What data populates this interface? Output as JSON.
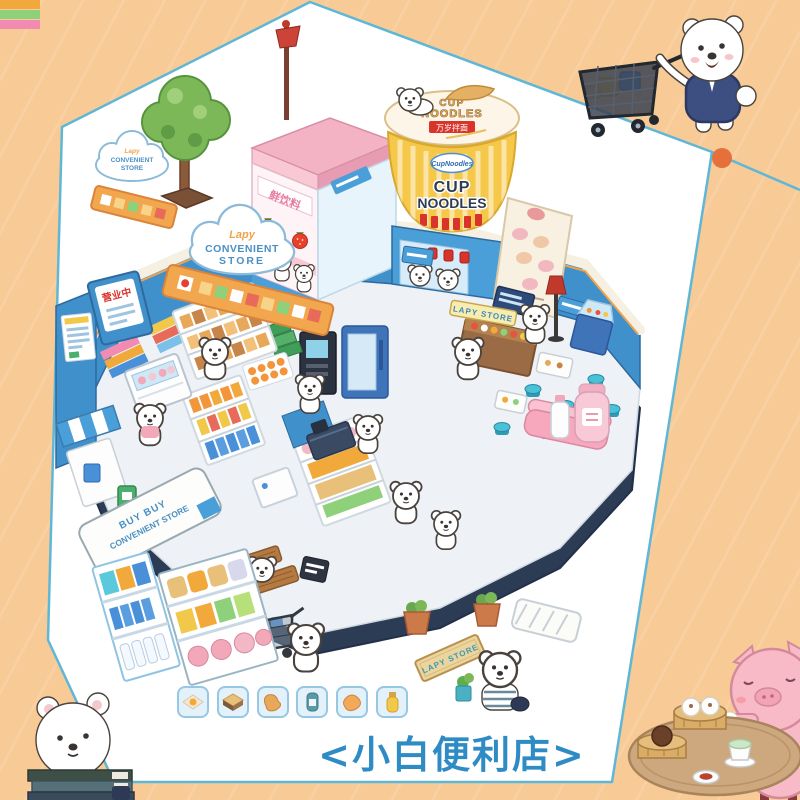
{
  "caption": "<小白便利店>",
  "colors": {
    "background": "#f8ca95",
    "panel": "#ffffff",
    "panel_border": "#5fb7d8",
    "accent_dot": "#e5703c",
    "caption_blue": "#2f8bc4",
    "store_wall_blue": "#4090cc",
    "base_navy": "#2d3c55",
    "cup_yellow": "#f6c84a",
    "banner_orange": "#f2a64e"
  },
  "signs": {
    "cloud_small_script": "Lapy",
    "cloud_small_line1": "CONVENIENT",
    "cloud_small_line2": "STORE",
    "cloud_large_script": "Lapy",
    "cloud_large_line1": "CONVENIENT",
    "cloud_large_line2": "STORE",
    "open_sign": "营业中",
    "drink_shop_sign": "鲜饮料",
    "cup_lid_line1": "CUP",
    "cup_lid_line2": "NOODLES",
    "cup_lid_badge": "万岁拌面",
    "cup_logo": "CupNoodles",
    "cup_body_line1": "CUP",
    "cup_body_line2": "NOODLES",
    "counter_sign": "LAPY STORE",
    "wooden_sign": "LAPY STORE",
    "floor_mat_line1": "BUY BUY",
    "floor_mat_line2": "CONVENIENT STORE"
  },
  "item_tiles": [
    {
      "name": "egg-dish"
    },
    {
      "name": "sandwich"
    },
    {
      "name": "fried-snack"
    },
    {
      "name": "canned-drink"
    },
    {
      "name": "bread-bun"
    },
    {
      "name": "milk-tea-bottle"
    }
  ],
  "characters": [
    {
      "name": "bear-pushing-cart",
      "location": "top-right"
    },
    {
      "name": "bear-with-books",
      "location": "bottom-left"
    },
    {
      "name": "pig-eating-dimsum",
      "location": "bottom-right"
    },
    {
      "name": "bear-striped-shirt",
      "location": "bottom-center"
    },
    {
      "name": "shopper-bears",
      "location": "inside-store"
    }
  ]
}
